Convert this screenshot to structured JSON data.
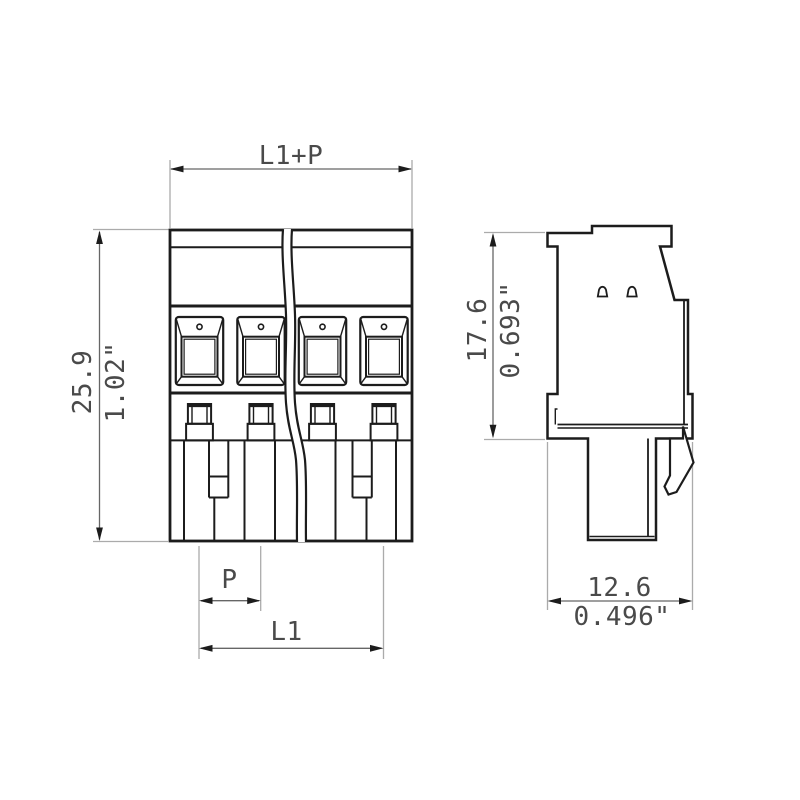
{
  "colors": {
    "line-color": "#1c1c1c",
    "dim-line-color": "#666666",
    "ext-line-color": "#ababab",
    "arrow-color": "#1c1c1c",
    "text-color": "#4a4a4a",
    "bg-color": "#ffffff"
  },
  "drawing": {
    "front_view": {
      "poles": 4,
      "dim_top": "L1+P",
      "dim_height_mm": "25.9",
      "dim_height_inch": "1.02\"",
      "dim_pitch": "P",
      "dim_length": "L1"
    },
    "side_view": {
      "dim_height_mm": "17.6",
      "dim_height_inch": "0.693\"",
      "dim_width_mm": "12.6",
      "dim_width_inch": "0.496\""
    }
  }
}
